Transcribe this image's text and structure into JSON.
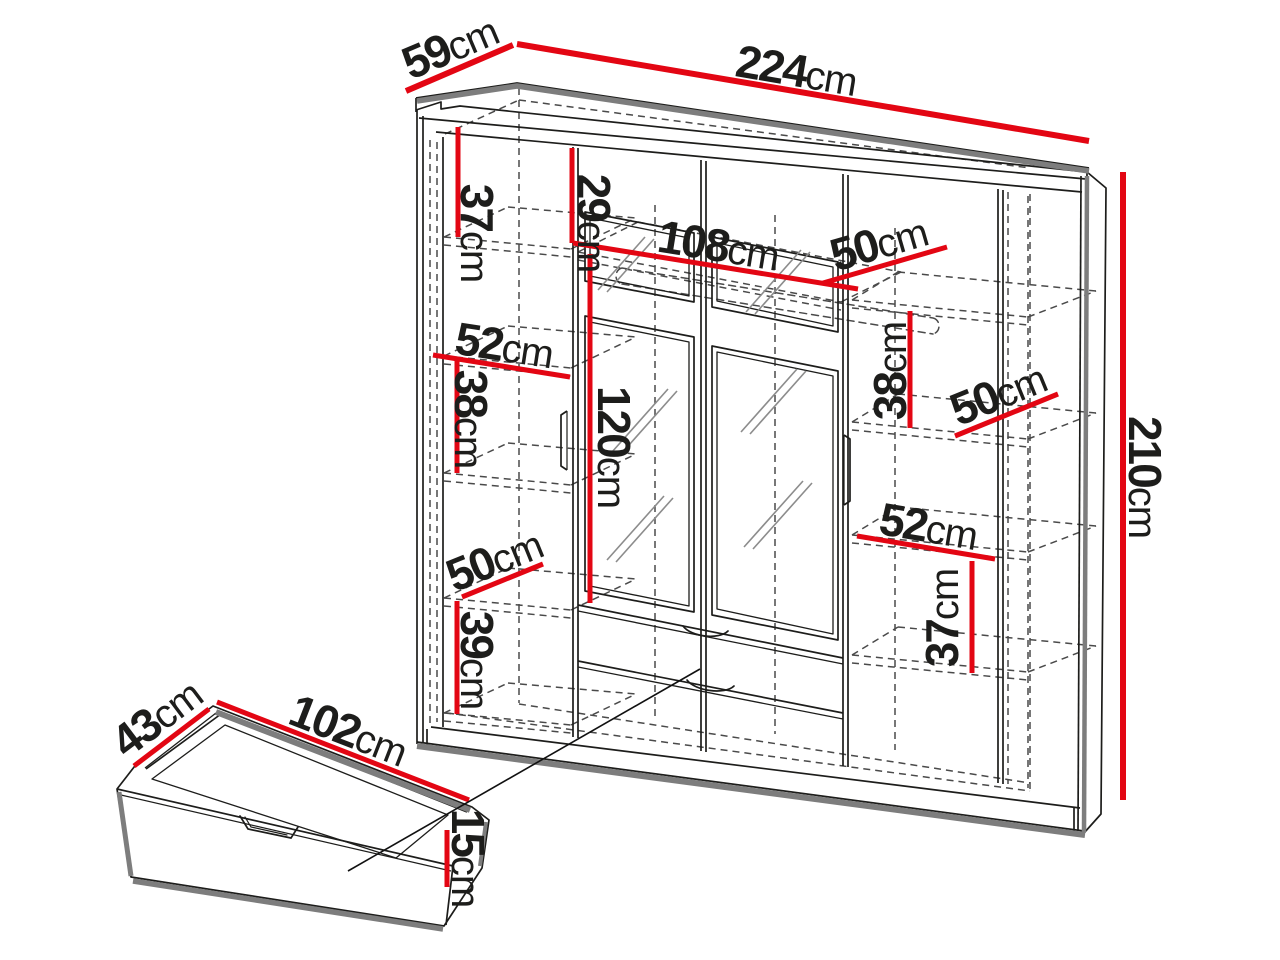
{
  "meta": {
    "background": "#ffffff",
    "accent_color": "#e30613",
    "ink_color": "#1d1d1b",
    "shadow_color": "#7d7d7d"
  },
  "dimensions": {
    "top_depth": {
      "value": "59",
      "unit": "cm"
    },
    "top_width": {
      "value": "224",
      "unit": "cm"
    },
    "height": {
      "value": "210",
      "unit": "cm"
    },
    "left_top_shelf": {
      "value": "37",
      "unit": "cm"
    },
    "middle_top_gap": {
      "value": "29",
      "unit": "cm"
    },
    "middle_width": {
      "value": "108",
      "unit": "cm"
    },
    "middle_shelf_depth": {
      "value": "50",
      "unit": "cm"
    },
    "right_upper_shelf": {
      "value": "38",
      "unit": "cm"
    },
    "right_shelf_depth": {
      "value": "50",
      "unit": "cm"
    },
    "left_shelf_width": {
      "value": "52",
      "unit": "cm"
    },
    "left_middle_shelf": {
      "value": "38",
      "unit": "cm"
    },
    "mirror_section_height": {
      "value": "120",
      "unit": "cm"
    },
    "left_shelf_depth": {
      "value": "50",
      "unit": "cm"
    },
    "left_lower_shelf": {
      "value": "39",
      "unit": "cm"
    },
    "right_lower_width": {
      "value": "52",
      "unit": "cm"
    },
    "right_lower_shelf": {
      "value": "37",
      "unit": "cm"
    },
    "drawer_depth": {
      "value": "43",
      "unit": "cm"
    },
    "drawer_width": {
      "value": "102",
      "unit": "cm"
    },
    "drawer_height": {
      "value": "15",
      "unit": "cm"
    }
  }
}
